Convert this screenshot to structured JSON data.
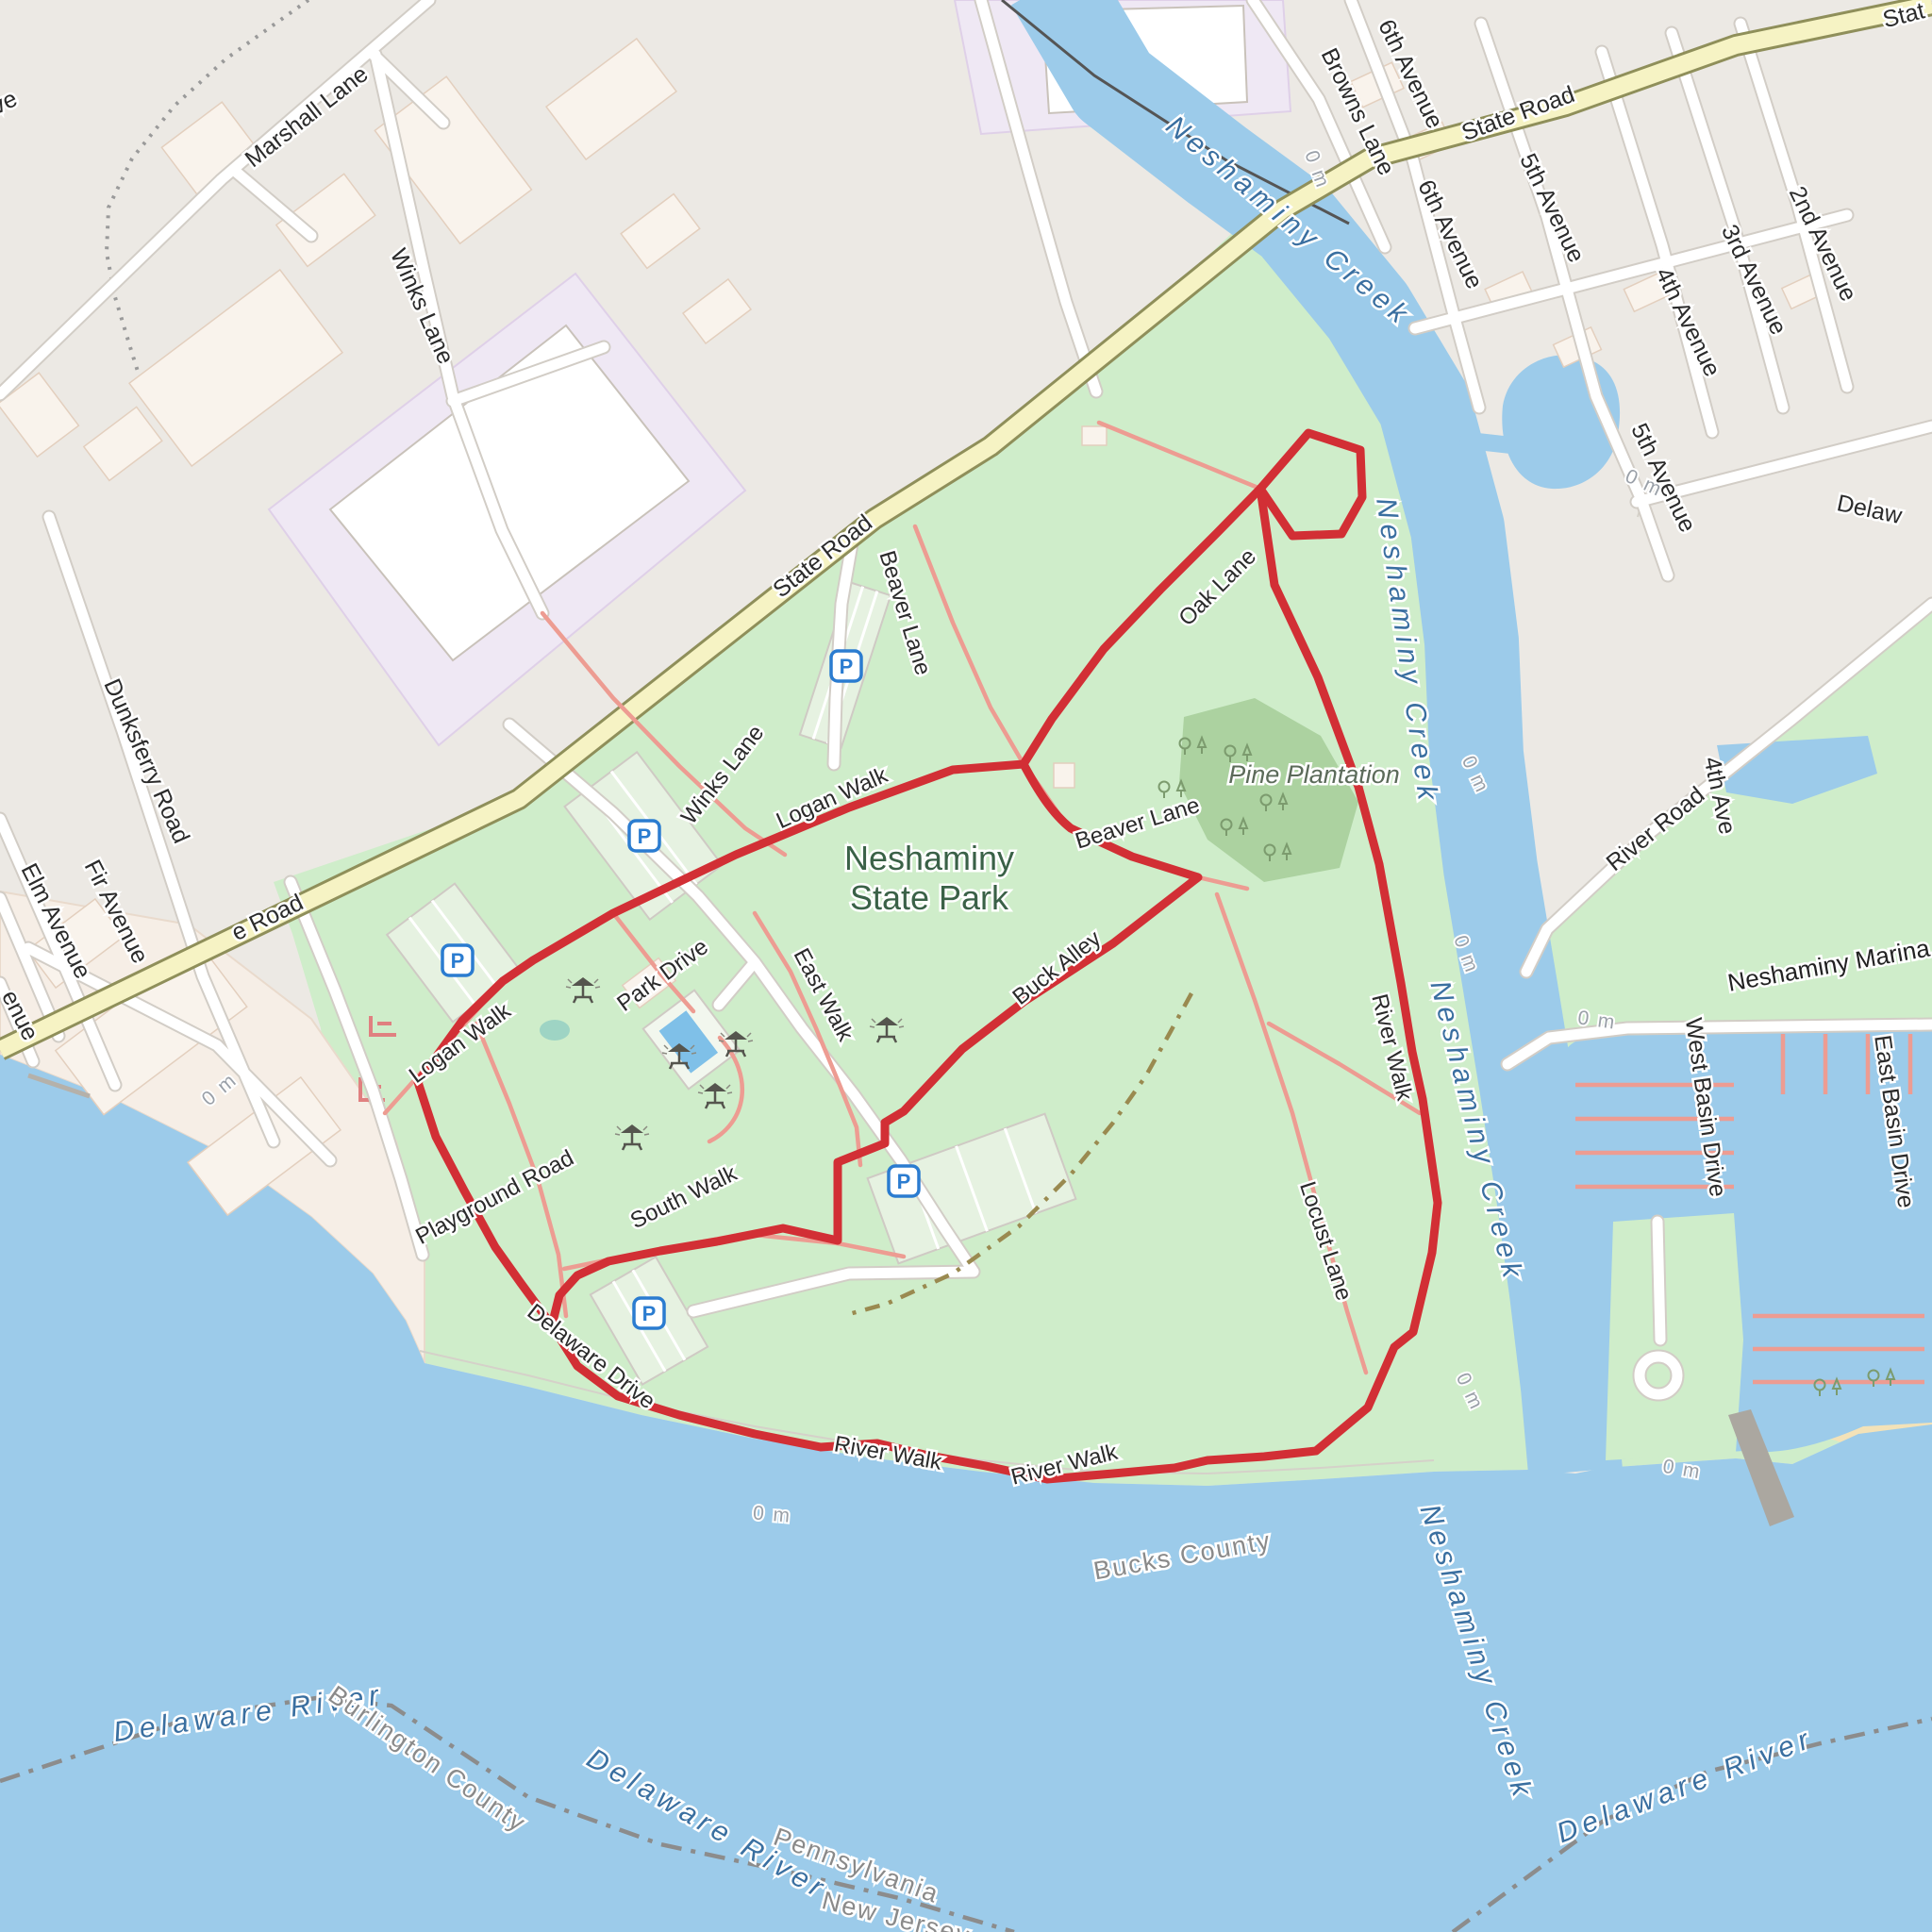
{
  "map_labels": {
    "roads": {
      "state_road": "State Road",
      "state_road_partial_top_right": "Stat",
      "state_road_partial_left": "e Road",
      "marshall_lane": "Marshall Lane",
      "winks_lane": "Winks Lane",
      "browns_lane": "Browns Lane",
      "sixth_avenue": "6th Avenue",
      "fifth_avenue": "5th Avenue",
      "fourth_avenue": "4th Avenue",
      "fourth_avenue_partial": "4th Ave",
      "third_avenue": "3rd Avenue",
      "second_avenue": "2nd Avenue",
      "delaware_avenue_partial": "Delaw",
      "dunksferry_road": "Dunksferry Road",
      "fir_avenue": "Fir Avenue",
      "elm_avenue": "Elm Avenue",
      "avenue_partial_left": "enue",
      "avenue_partial_top_left": "ve",
      "river_road": "River Road",
      "west_basin_drive": "West Basin Drive",
      "east_basin_drive": "East Basin Drive"
    },
    "park_paths": {
      "logan_walk": "Logan Walk",
      "beaver_lane": "Beaver Lane",
      "oak_lane": "Oak Lane",
      "park_drive": "Park Drive",
      "east_walk": "East Walk",
      "south_walk": "South Walk",
      "buck_alley": "Buck Alley",
      "playground_road": "Playground Road",
      "delaware_drive": "Delaware Drive",
      "river_walk": "River Walk",
      "locust_lane": "Locust Lane"
    },
    "water": {
      "neshaminy_creek": "Neshaminy Creek",
      "delaware_river": "Delaware River"
    },
    "areas": {
      "park_name_line1": "Neshaminy",
      "park_name_line2": "State Park",
      "pine_plantation": "Pine Plantation",
      "marina": "Neshaminy Marina"
    },
    "boundaries": {
      "burlington_county": "Burlington County",
      "bucks_county": "Bucks County",
      "pennsylvania": "Pennsylvania",
      "new_jersey": "New Jersey"
    },
    "contour": {
      "zero_m": "0 m"
    },
    "icons": {
      "parking": "P"
    }
  },
  "colors": {
    "route_red": "#D22F35",
    "water_blue": "#9CCBEA",
    "park_green": "#CFEDCA",
    "wood_green": "#ACD2A0",
    "state_road_yellow": "#F6F3C4",
    "path_salmon": "#ED9C92",
    "parking_blue": "#2B7CD0"
  }
}
